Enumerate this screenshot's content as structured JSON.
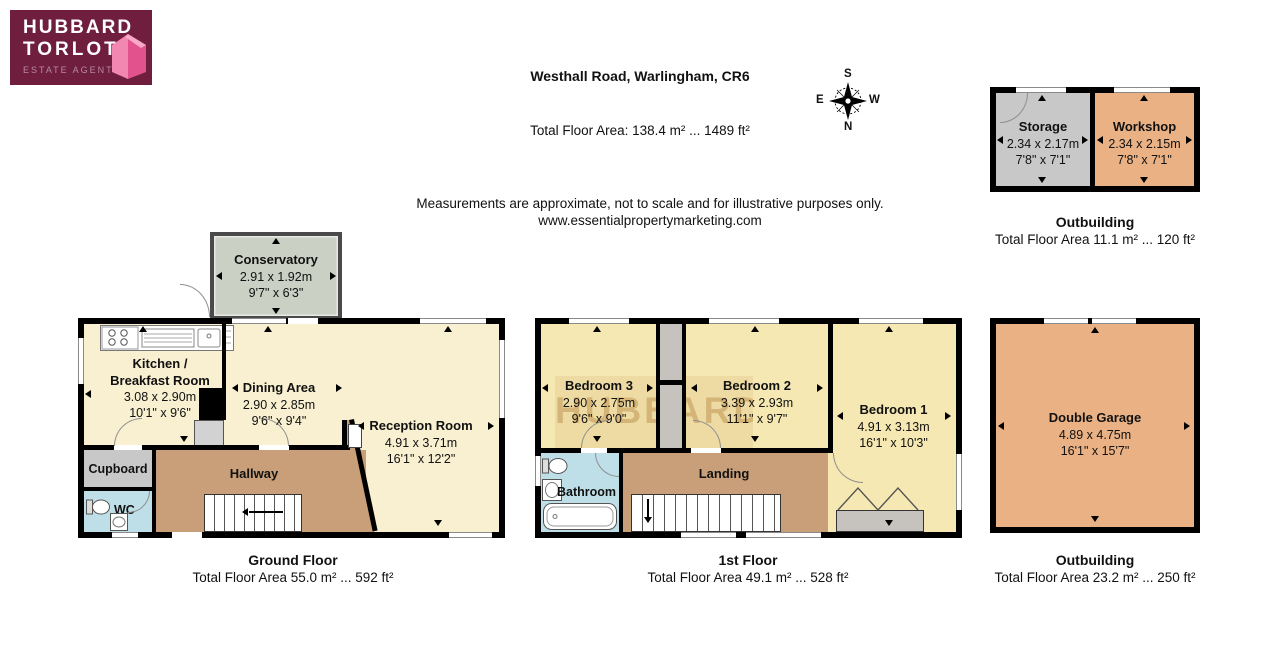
{
  "colors": {
    "logo_bg": "#6f1e3e",
    "logo_pink": "#ee6496",
    "cream": "#f8f0d0",
    "bedroom_yellow": "#f6e8b2",
    "hall_tan": "#c89f78",
    "outbuilding_orange": "#e9b184",
    "storage_gray": "#c8c8c8",
    "bathroom_blue": "#bedfe7",
    "conservatory_green": "#cad0c3",
    "wall_black": "#000000"
  },
  "logo": {
    "line1": "HUBBARD",
    "line2": "TORLOT",
    "tagline": "ESTATE AGENTS"
  },
  "header": {
    "address": "Westhall Road, Warlingham, CR6",
    "total_area": "Total Floor Area: 138.4 m² ... 1489 ft²",
    "disclaimer": "Measurements are approximate, not to scale and for illustrative purposes only.",
    "website": "www.essentialpropertymarketing.com"
  },
  "compass": {
    "top": "S",
    "bottom": "N",
    "left": "E",
    "right": "W"
  },
  "watermark": {
    "line1": "HUBBARD",
    "line2": "TORLOT"
  },
  "captions": {
    "ground": {
      "title": "Ground Floor",
      "area": "Total Floor Area 55.0 m² ... 592 ft²"
    },
    "first": {
      "title": "1st Floor",
      "area": "Total Floor Area 49.1 m² ... 528 ft²"
    },
    "outbuilding_top": {
      "title": "Outbuilding",
      "area": "Total Floor Area 11.1 m² ... 120 ft²"
    },
    "outbuilding_garage": {
      "title": "Outbuilding",
      "area": "Total Floor Area 23.2 m² ... 250 ft²"
    }
  },
  "rooms": {
    "conservatory": {
      "name": "Conservatory",
      "metric": "2.91 x 1.92m",
      "imperial": "9'7\" x 6'3\""
    },
    "kitchen": {
      "name_line1": "Kitchen /",
      "name_line2": "Breakfast Room",
      "metric": "3.08 x 2.90m",
      "imperial": "10'1\" x 9'6\""
    },
    "dining": {
      "name": "Dining Area",
      "metric": "2.90 x 2.85m",
      "imperial": "9'6\" x 9'4\""
    },
    "reception": {
      "name": "Reception Room",
      "metric": "4.91 x 3.71m",
      "imperial": "16'1\" x 12'2\""
    },
    "hallway": {
      "name": "Hallway"
    },
    "cupboard": {
      "name": "Cupboard"
    },
    "wc": {
      "name": "WC"
    },
    "bedroom1": {
      "name": "Bedroom 1",
      "metric": "4.91 x 3.13m",
      "imperial": "16'1\" x 10'3\""
    },
    "bedroom2": {
      "name": "Bedroom 2",
      "metric": "3.39 x 2.93m",
      "imperial": "11'1\" x 9'7\""
    },
    "bedroom3": {
      "name": "Bedroom 3",
      "metric": "2.90 x 2.75m",
      "imperial": "9'6\" x 9'0\""
    },
    "bathroom": {
      "name": "Bathroom"
    },
    "landing": {
      "name": "Landing"
    },
    "storage": {
      "name": "Storage",
      "metric": "2.34 x 2.17m",
      "imperial": "7'8\" x 7'1\""
    },
    "workshop": {
      "name": "Workshop",
      "metric": "2.34 x 2.15m",
      "imperial": "7'8\" x 7'1\""
    },
    "garage": {
      "name": "Double Garage",
      "metric": "4.89 x 4.75m",
      "imperial": "16'1\" x 15'7\""
    }
  }
}
